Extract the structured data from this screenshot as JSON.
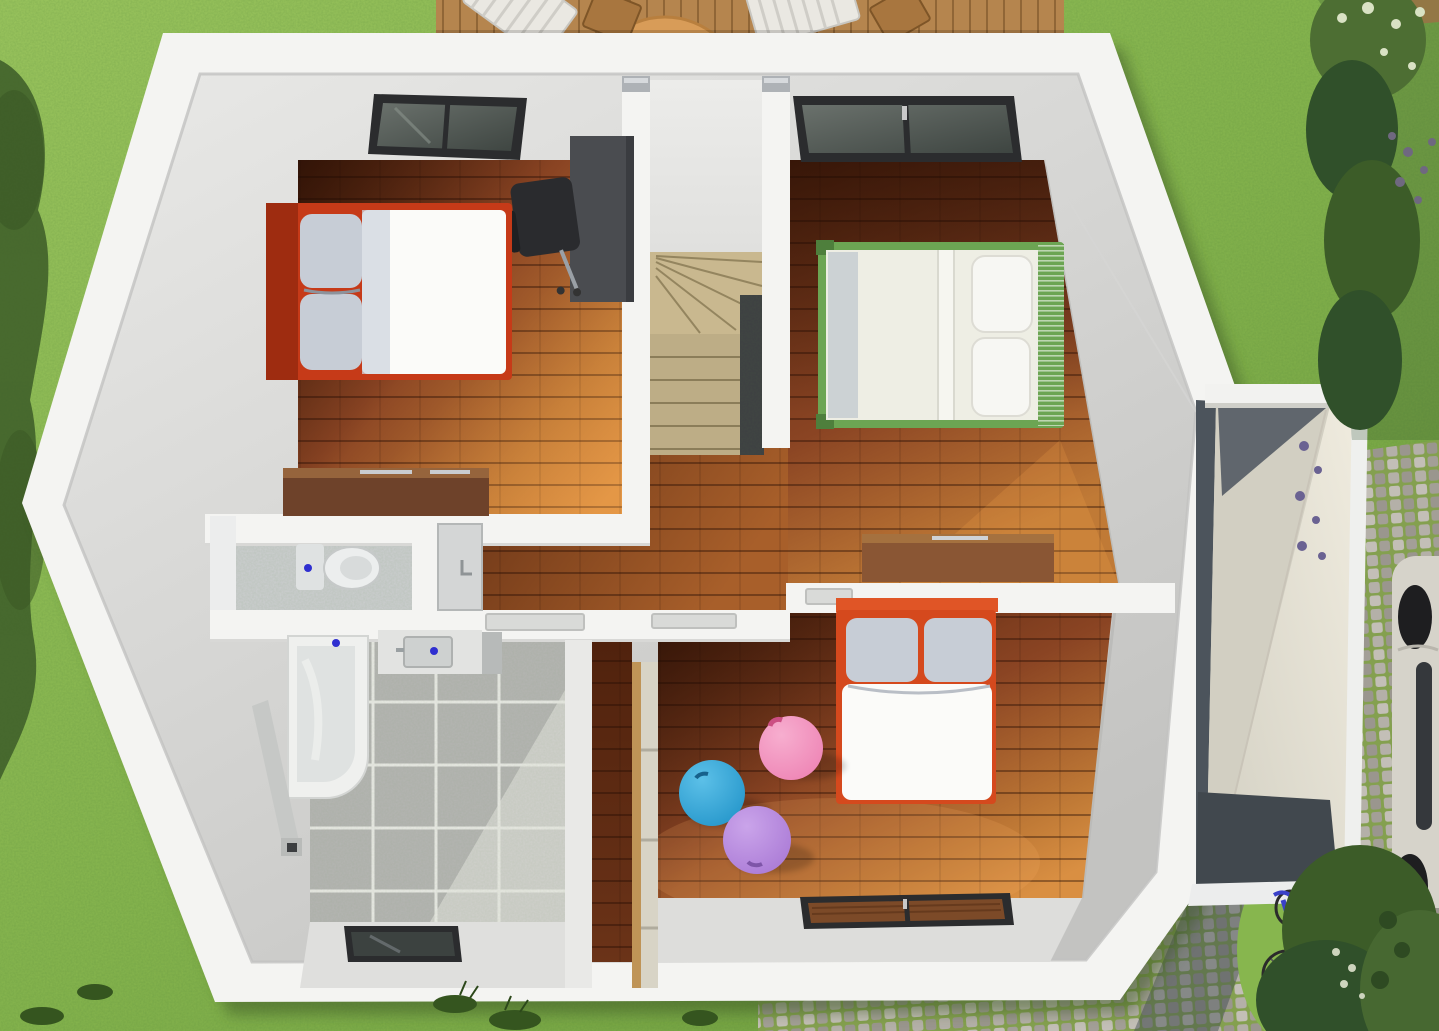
{
  "meta": {
    "description": "Top-down 3D architectural render of an upper floor with garden, deck, garage annex, car and bicycle"
  },
  "palette": {
    "grass": "#87b64e",
    "grassDark": "#6e9b3d",
    "grassLight": "#9dc75f",
    "foliage": "#3c5c28",
    "hedge": "#30502a",
    "hedgeLight": "#4d6e33",
    "blossom": "#d9e2c4",
    "berry": "#6f6880",
    "lavender": "#6a6292",
    "deckWood": "#b5854e",
    "deckWoodDark": "#8d6233",
    "loungeChair": "#eae8e2",
    "tableWood": "#d89c58",
    "wallWhite": "#f4f4f2",
    "wallShade": "#e2e2e0",
    "wallDark": "#cfcfcd",
    "slopeLight": "#e9e9e7",
    "slopeDark": "#c3c3c1",
    "floorDark": "#50220d",
    "floorMid": "#8a4423",
    "floorLight": "#c07a36",
    "floorBright": "#d98f42",
    "hallDark": "#5e2c13",
    "hallLight": "#a85f2a",
    "stairTread": "#c9b88f",
    "stairShade": "#94855f",
    "rail": "#3e3f43",
    "tile": "#b5b5b3",
    "tileLight": "#d6d6d2",
    "grout": "#e8e8e4",
    "tub": "#eff0ee",
    "fixture": "#e2e3e1",
    "fixtureShade": "#b7bab9",
    "drainBlue": "#2f2fd0",
    "bedRed": "#c63a18",
    "bedRedDark": "#9e2c10",
    "pillow": "#c7cdd6",
    "duvet": "#fbfbf9",
    "bedGreen": "#6ca553",
    "bedGreenDark": "#4e7f3c",
    "mattressCream": "#eeeee4",
    "sheetShade": "#c3cbcf",
    "kidRed": "#d5491d",
    "ballBlue": "#2697cb",
    "ballBlueHi": "#5cc0e8",
    "ballPink": "#ee85b5",
    "ballPinkHi": "#f7aecf",
    "ballPurple": "#ab7bd6",
    "ballPurpleHi": "#caa4ea",
    "wardrobeEdge": "#bf9457",
    "wardrobePanel": "#d8d4c6",
    "dresserDark": "#6e422a",
    "dresserLight": "#96643c",
    "dresser2": "#8a5634",
    "desk": "#4a4c50",
    "deskDark": "#3a3c40",
    "chairBlack": "#2a2b2e",
    "frame": "#2b2c2e",
    "glass": "#555b58",
    "glassDark": "#3c4240",
    "glassWood": "#7c4a28",
    "cobble": "#b4b0a8",
    "cobbleDark": "#9a968e",
    "cobbleGap": "#84a04f",
    "garageRoof": "#ebe7da",
    "garageRoofShade": "#d2cfc2",
    "garageDark": "#60666d",
    "garageOpening": "#41484e",
    "carBody": "#d6d3ca",
    "carDark": "#1e1e20",
    "carWindow": "#35383c",
    "bike": "#3a41c8"
  },
  "exterior": {
    "areas": [
      "lawn",
      "wood-deck-top",
      "deck-corner-top-right",
      "hedge-top-right",
      "cobblestone-path",
      "garage-annex",
      "parked-car",
      "bicycle",
      "shrubs-bottom-right",
      "tree-shadow-left"
    ]
  },
  "interior": {
    "rooms": [
      {
        "id": "bedroom-1",
        "floor": "wood"
      },
      {
        "id": "bedroom-2",
        "floor": "wood"
      },
      {
        "id": "kids-bedroom",
        "floor": "wood"
      },
      {
        "id": "bathroom",
        "floor": "tile"
      },
      {
        "id": "toilet",
        "floor": "tile"
      },
      {
        "id": "hallway",
        "floor": "wood"
      },
      {
        "id": "staircase",
        "floor": "stairs"
      }
    ],
    "furniture": [
      "double-bed-red",
      "double-bed-green",
      "kids-bed-red",
      "desk",
      "office-chair",
      "dresser-bedroom-1",
      "dresser-bedroom-2",
      "wardrobe",
      "bathtub",
      "sink",
      "toilet",
      "vanity",
      "gym-ball-blue",
      "gym-ball-pink",
      "gym-ball-purple",
      "lounge-chairs",
      "patio-table",
      "skylight-windows"
    ]
  }
}
